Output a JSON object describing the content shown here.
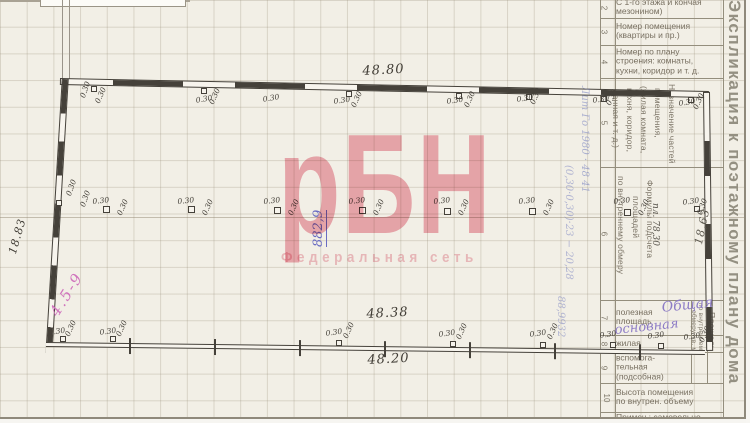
{
  "watermark": {
    "big": "рБН",
    "sub": "Федеральная сеть"
  },
  "table": {
    "vertical_title": "Экспликация к поэтажному плану дома",
    "rows": [
      {
        "num": "2",
        "label": "С 1-го этажа и кончая\nмезонином)",
        "y": -3,
        "h": 21
      },
      {
        "num": "3",
        "label": "Номер помещения\n(квартиры и пр.)",
        "y": 18,
        "h": 27
      },
      {
        "num": "4",
        "label": "Номер по плану\nстроения: комнаты,\nкухни, коридор и т. д.",
        "y": 45,
        "h": 33
      },
      {
        "num": "5",
        "label": "",
        "y": 78,
        "h": 89
      },
      {
        "num": "6",
        "label": "",
        "y": 167,
        "h": 133
      },
      {
        "num": "7",
        "label": "полезная\nплощадь",
        "y": 300,
        "h": 35
      },
      {
        "num": "8",
        "label": "жилая",
        "y": 335,
        "h": 17
      },
      {
        "num": "9",
        "label": "вспомога-\nтельная\n(подсобная)",
        "y": 352,
        "h": 31
      },
      {
        "num": "10",
        "label": "Высота помещения\nпо внутрен. объему",
        "y": 383,
        "h": 29
      },
      {
        "num": "",
        "label": "Примеч.: самовольно",
        "y": 412,
        "h": 11
      }
    ],
    "rotated": [
      {
        "text": "Назначение частей",
        "x": 667,
        "y": 84
      },
      {
        "text": "помещения,",
        "x": 653,
        "y": 88
      },
      {
        "text": "(жилая комната,",
        "x": 639,
        "y": 86
      },
      {
        "text": "кухня, коридор,",
        "x": 625,
        "y": 88
      },
      {
        "text": "ванная и т. д.)",
        "x": 611,
        "y": 90
      },
      {
        "text": "Формулы подсчета",
        "x": 645,
        "y": 180
      },
      {
        "text": "площадей",
        "x": 631,
        "y": 196
      },
      {
        "text": "по внутреннему обмеру",
        "x": 616,
        "y": 176
      },
      {
        "text": "по внутреннему",
        "x": 697,
        "y": 303,
        "size": 6.5
      },
      {
        "text": "обмеру, кв. м",
        "x": 690,
        "y": 310,
        "size": 6.5
      },
      {
        "text": "Площадь",
        "x": 707,
        "y": 312
      }
    ],
    "hlines": [
      {
        "y": 18
      },
      {
        "y": 45
      },
      {
        "y": 78
      },
      {
        "y": 167
      },
      {
        "y": 300
      },
      {
        "y": 335
      },
      {
        "y": 352
      },
      {
        "y": 383
      },
      {
        "y": 412
      }
    ]
  },
  "plan": {
    "small_label": "0.30",
    "dims": [
      {
        "text": "48.80",
        "x": 362,
        "y": 64,
        "r": -3
      },
      {
        "text": "48.38",
        "x": 366,
        "y": 307,
        "r": -3
      },
      {
        "text": "48.20",
        "x": 367,
        "y": 353,
        "r": -3
      },
      {
        "text": "18.83",
        "x": 6,
        "y": 252,
        "r": -74,
        "size": 11
      },
      {
        "text": "18,63",
        "x": 692,
        "y": 243,
        "r": -78,
        "size": 11,
        "color": "#5d594f"
      }
    ],
    "labels030": [
      {
        "x": 78,
        "y": 96,
        "r": -70
      },
      {
        "x": 93,
        "y": 101,
        "r": -66
      },
      {
        "x": 195,
        "y": 96,
        "r": -10
      },
      {
        "x": 207,
        "y": 102,
        "r": -66
      },
      {
        "x": 262,
        "y": 95,
        "r": -10
      },
      {
        "x": 333,
        "y": 97,
        "r": -8
      },
      {
        "x": 349,
        "y": 105,
        "r": -66
      },
      {
        "x": 446,
        "y": 97,
        "r": -8
      },
      {
        "x": 462,
        "y": 105,
        "r": -66
      },
      {
        "x": 516,
        "y": 95,
        "r": -8
      },
      {
        "x": 528,
        "y": 102,
        "r": -66
      },
      {
        "x": 592,
        "y": 96,
        "r": -8
      },
      {
        "x": 604,
        "y": 103,
        "r": -66
      },
      {
        "x": 678,
        "y": 99,
        "r": -8
      },
      {
        "x": 691,
        "y": 107,
        "r": -66
      },
      {
        "x": 92,
        "y": 197,
        "r": -6
      },
      {
        "x": 115,
        "y": 213,
        "r": -66
      },
      {
        "x": 177,
        "y": 197,
        "r": -6
      },
      {
        "x": 200,
        "y": 213,
        "r": -66
      },
      {
        "x": 263,
        "y": 197,
        "r": -6
      },
      {
        "x": 286,
        "y": 213,
        "r": -66
      },
      {
        "x": 348,
        "y": 197,
        "r": -6
      },
      {
        "x": 371,
        "y": 213,
        "r": -66
      },
      {
        "x": 433,
        "y": 197,
        "r": -6
      },
      {
        "x": 456,
        "y": 213,
        "r": -66
      },
      {
        "x": 518,
        "y": 197,
        "r": -6
      },
      {
        "x": 541,
        "y": 213,
        "r": -66
      },
      {
        "x": 613,
        "y": 197,
        "r": -6
      },
      {
        "x": 636,
        "y": 213,
        "r": -66
      },
      {
        "x": 64,
        "y": 194,
        "r": -70
      },
      {
        "x": 78,
        "y": 205,
        "r": -70
      },
      {
        "x": 682,
        "y": 198,
        "r": -8
      },
      {
        "x": 695,
        "y": 213,
        "r": -70
      },
      {
        "x": 48,
        "y": 328,
        "r": -8
      },
      {
        "x": 63,
        "y": 334,
        "r": -66
      },
      {
        "x": 99,
        "y": 328,
        "r": -8
      },
      {
        "x": 114,
        "y": 334,
        "r": -66
      },
      {
        "x": 325,
        "y": 329,
        "r": -8
      },
      {
        "x": 341,
        "y": 336,
        "r": -66
      },
      {
        "x": 438,
        "y": 330,
        "r": -8
      },
      {
        "x": 454,
        "y": 337,
        "r": -66
      },
      {
        "x": 529,
        "y": 330,
        "r": -8
      },
      {
        "x": 545,
        "y": 337,
        "r": -66
      },
      {
        "x": 599,
        "y": 331,
        "r": -8
      },
      {
        "x": 647,
        "y": 332,
        "r": -8
      },
      {
        "x": 683,
        "y": 333,
        "r": -8
      },
      {
        "x": 697,
        "y": 340,
        "r": -66
      }
    ],
    "squares": [
      {
        "x": 103,
        "y": 206,
        "w": 7,
        "h": 7
      },
      {
        "x": 188,
        "y": 206,
        "w": 7,
        "h": 7
      },
      {
        "x": 274,
        "y": 207,
        "w": 7,
        "h": 7
      },
      {
        "x": 359,
        "y": 207,
        "w": 7,
        "h": 7
      },
      {
        "x": 444,
        "y": 208,
        "w": 7,
        "h": 7
      },
      {
        "x": 529,
        "y": 208,
        "w": 7,
        "h": 7
      },
      {
        "x": 624,
        "y": 209,
        "w": 7,
        "h": 7
      },
      {
        "x": 91,
        "y": 86
      },
      {
        "x": 201,
        "y": 88
      },
      {
        "x": 346,
        "y": 91
      },
      {
        "x": 456,
        "y": 93
      },
      {
        "x": 526,
        "y": 94
      },
      {
        "x": 601,
        "y": 96
      },
      {
        "x": 688,
        "y": 97
      },
      {
        "x": 60,
        "y": 336
      },
      {
        "x": 110,
        "y": 336
      },
      {
        "x": 336,
        "y": 340
      },
      {
        "x": 450,
        "y": 341
      },
      {
        "x": 540,
        "y": 342
      },
      {
        "x": 610,
        "y": 342
      },
      {
        "x": 658,
        "y": 343
      },
      {
        "x": 56,
        "y": 200
      },
      {
        "x": 694,
        "y": 206
      }
    ]
  },
  "handwriting": [
    {
      "text": "882,9",
      "x": 311,
      "y": 247,
      "r": -90,
      "size": 13,
      "color": "#6a6cc2",
      "und": true
    },
    {
      "text": "Лит Го 1980 · 48 41",
      "x": 579,
      "y": 86,
      "size": 10,
      "color": "rgba(112,122,190,0.55)",
      "vert": true,
      "h": 175
    },
    {
      "text": "(0,30·0,30)·23 − 20,28",
      "x": 563,
      "y": 165,
      "size": 10,
      "color": "rgba(112,122,190,0.5)",
      "vert": true,
      "h": 190
    },
    {
      "text": "88,9932",
      "x": 555,
      "y": 296,
      "size": 10,
      "color": "rgba(112,122,190,0.5)",
      "vert": true,
      "h": 80
    },
    {
      "text": "пл. 78,30",
      "x": 650,
      "y": 203,
      "size": 9,
      "color": "#57534b",
      "vert": true,
      "h": 58
    },
    {
      "text": "Общая",
      "x": 661,
      "y": 300,
      "r": -6,
      "size": 14,
      "color": "#8d7cc6"
    },
    {
      "text": "основная",
      "x": 614,
      "y": 323,
      "r": -6,
      "size": 13,
      "color": "#8d7cc6"
    },
    {
      "text": "4.5-9",
      "x": 46,
      "y": 310,
      "r": -58,
      "size": 15,
      "color": "#d073bd",
      "ls": 2
    }
  ]
}
